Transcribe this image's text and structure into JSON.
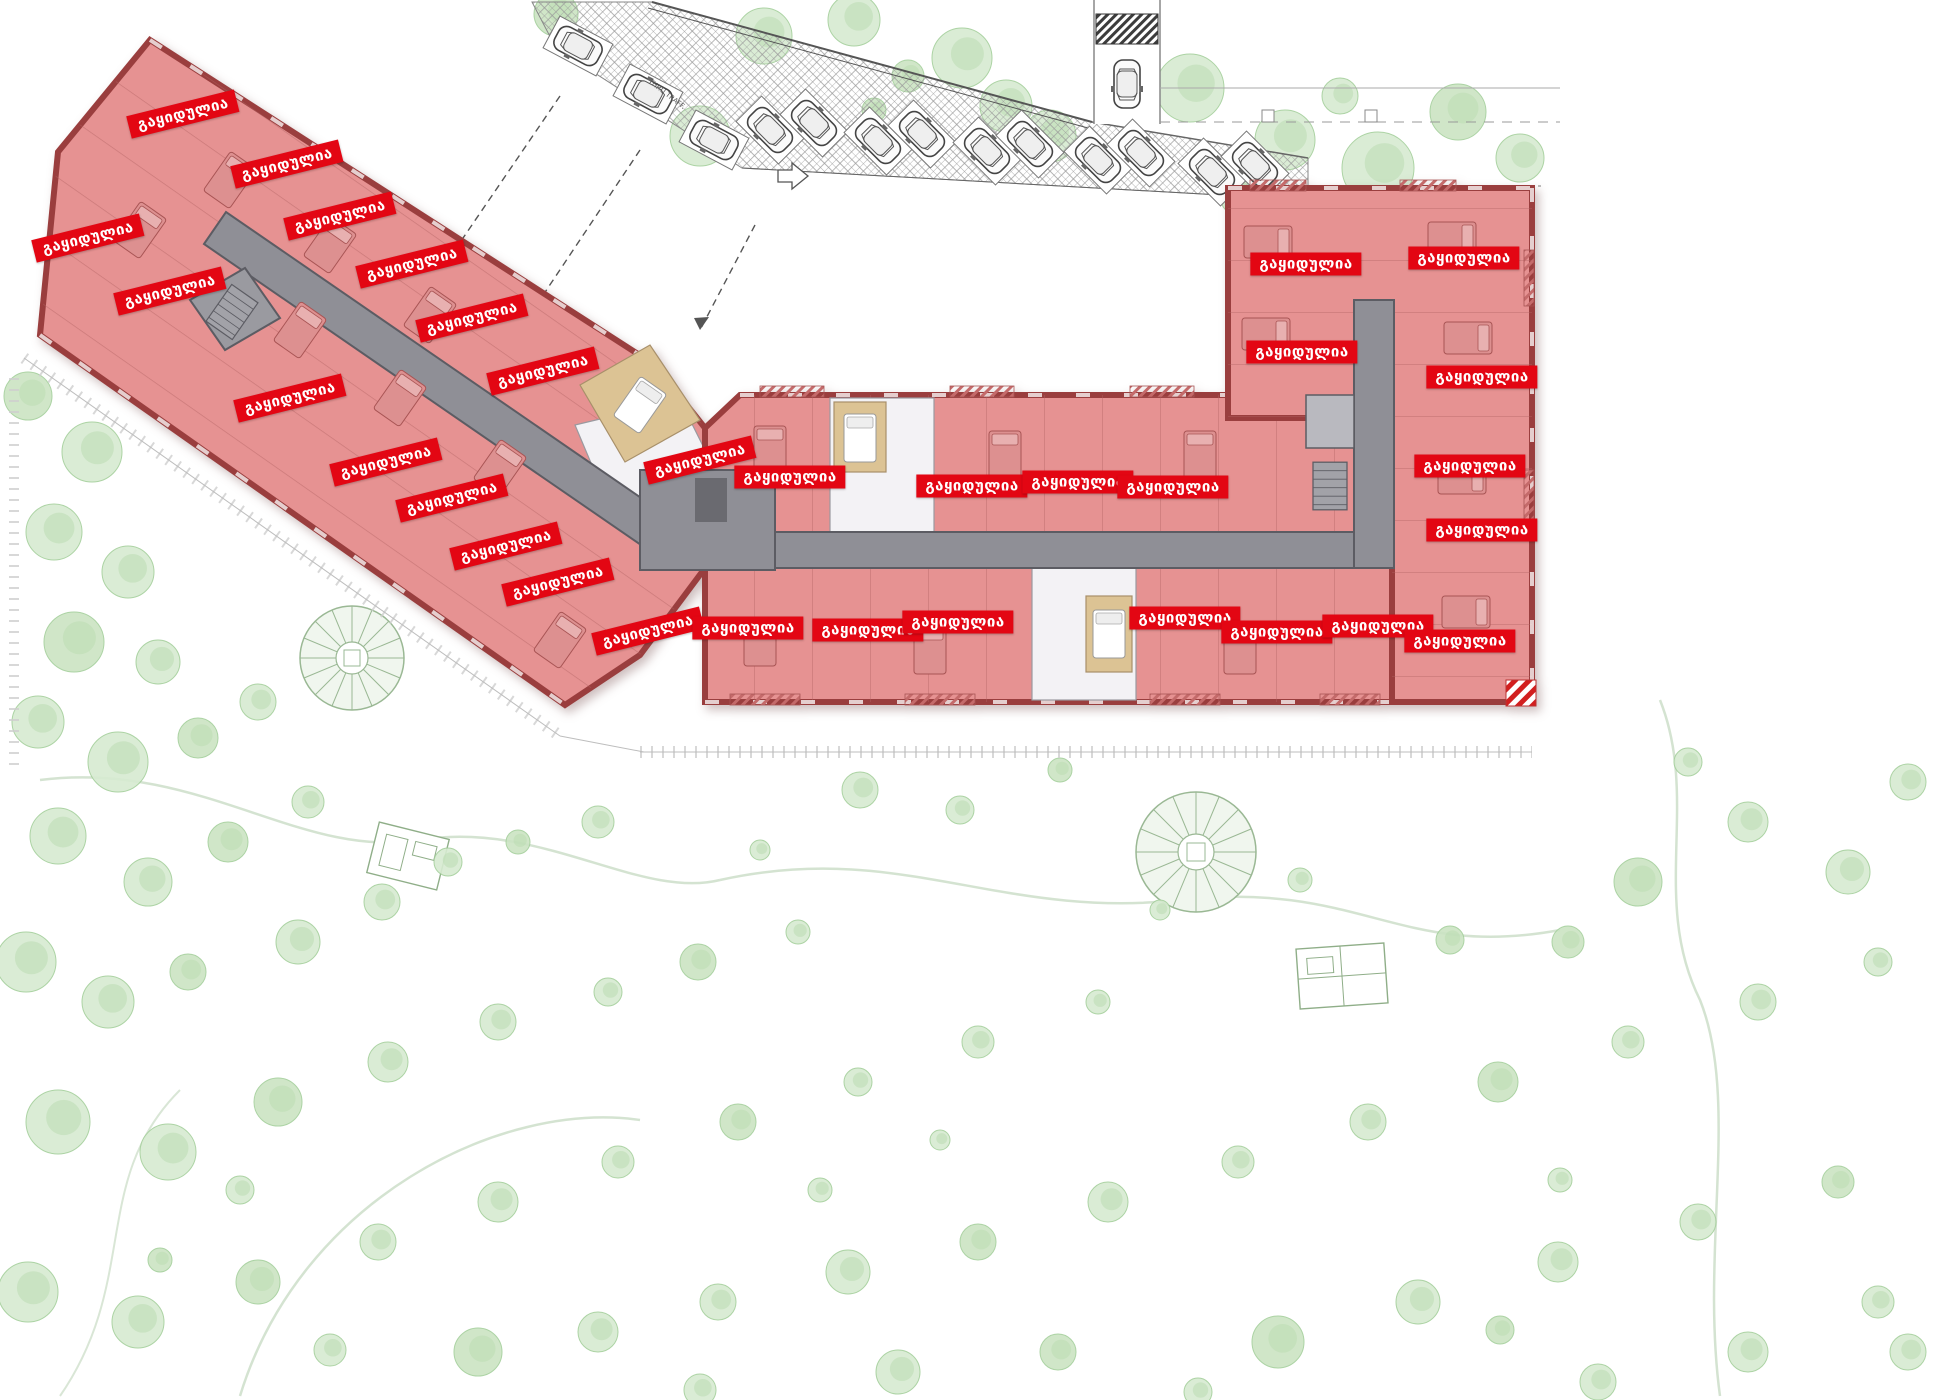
{
  "labels": {
    "sold": "გაყიდულია",
    "stop": "STOP",
    "traffic_note": "THRU TRAFF."
  },
  "colors": {
    "sold_badge_bg": "#e30613",
    "sold_badge_text": "#ffffff",
    "sold_fill": "#e69292",
    "sold_wall": "#9a3e3e",
    "partition": "#b26262",
    "corridor": "#8f8f96",
    "corridor_wall": "#5c5c63",
    "white_floor": "#f3f2f5",
    "wood_floor": "#dcc394",
    "tree_fill": "#d7ebd1",
    "tree_stroke": "#a4cf9b",
    "hatch_line": "#8a8a8a"
  },
  "sold_units": [
    {
      "x": 183,
      "y": 114,
      "rot": -14
    },
    {
      "x": 287,
      "y": 164,
      "rot": -14
    },
    {
      "x": 340,
      "y": 216,
      "rot": -14
    },
    {
      "x": 412,
      "y": 264,
      "rot": -14
    },
    {
      "x": 472,
      "y": 318,
      "rot": -14
    },
    {
      "x": 543,
      "y": 371,
      "rot": -14
    },
    {
      "x": 88,
      "y": 238,
      "rot": -14
    },
    {
      "x": 170,
      "y": 291,
      "rot": -14
    },
    {
      "x": 290,
      "y": 398,
      "rot": -14
    },
    {
      "x": 386,
      "y": 462,
      "rot": -14
    },
    {
      "x": 452,
      "y": 498,
      "rot": -14
    },
    {
      "x": 506,
      "y": 546,
      "rot": -14
    },
    {
      "x": 558,
      "y": 582,
      "rot": -14
    },
    {
      "x": 648,
      "y": 631,
      "rot": -14
    },
    {
      "x": 700,
      "y": 460,
      "rot": -14
    },
    {
      "x": 790,
      "y": 477,
      "rot": 0
    },
    {
      "x": 972,
      "y": 486,
      "rot": 0
    },
    {
      "x": 1078,
      "y": 482,
      "rot": 0
    },
    {
      "x": 1173,
      "y": 487,
      "rot": 0
    },
    {
      "x": 748,
      "y": 628,
      "rot": 0
    },
    {
      "x": 868,
      "y": 630,
      "rot": 0
    },
    {
      "x": 958,
      "y": 622,
      "rot": 0
    },
    {
      "x": 1185,
      "y": 618,
      "rot": 0
    },
    {
      "x": 1277,
      "y": 632,
      "rot": 0
    },
    {
      "x": 1378,
      "y": 626,
      "rot": 0
    },
    {
      "x": 1306,
      "y": 264,
      "rot": 0
    },
    {
      "x": 1464,
      "y": 258,
      "rot": 0
    },
    {
      "x": 1302,
      "y": 352,
      "rot": 0
    },
    {
      "x": 1482,
      "y": 377,
      "rot": 0
    },
    {
      "x": 1470,
      "y": 466,
      "rot": 0
    },
    {
      "x": 1482,
      "y": 530,
      "rot": 0
    },
    {
      "x": 1460,
      "y": 641,
      "rot": 0
    }
  ],
  "parking": {
    "cars": [
      {
        "x": 578,
        "y": 46,
        "rot": -62,
        "bay": true
      },
      {
        "x": 648,
        "y": 94,
        "rot": -62,
        "bay": true
      },
      {
        "x": 714,
        "y": 140,
        "rot": -62,
        "bay": true
      },
      {
        "x": 770,
        "y": 130,
        "rot": -45,
        "bay": true
      },
      {
        "x": 814,
        "y": 123,
        "rot": -45,
        "bay": true
      },
      {
        "x": 878,
        "y": 141,
        "rot": -45,
        "bay": true
      },
      {
        "x": 922,
        "y": 134,
        "rot": -45,
        "bay": true
      },
      {
        "x": 987,
        "y": 151,
        "rot": -45,
        "bay": true
      },
      {
        "x": 1030,
        "y": 144,
        "rot": -45,
        "bay": true
      },
      {
        "x": 1098,
        "y": 160,
        "rot": -45,
        "bay": true
      },
      {
        "x": 1141,
        "y": 153,
        "rot": -45,
        "bay": true
      },
      {
        "x": 1212,
        "y": 172,
        "rot": -45,
        "bay": true
      },
      {
        "x": 1255,
        "y": 165,
        "rot": -45,
        "bay": true
      },
      {
        "x": 1127,
        "y": 84,
        "rot": 180,
        "bay": false
      }
    ],
    "stop": {
      "x": 1313,
      "y": 223
    }
  },
  "landscape": {
    "trees": [
      [
        556,
        14,
        22
      ],
      [
        700,
        136,
        30
      ],
      [
        764,
        36,
        28
      ],
      [
        854,
        20,
        26
      ],
      [
        908,
        76,
        16
      ],
      [
        962,
        58,
        30
      ],
      [
        1006,
        106,
        26
      ],
      [
        1050,
        136,
        26
      ],
      [
        874,
        110,
        12
      ],
      [
        1190,
        88,
        34
      ],
      [
        1285,
        140,
        30
      ],
      [
        1378,
        168,
        36
      ],
      [
        1458,
        112,
        28
      ],
      [
        1520,
        158,
        24
      ],
      [
        1340,
        96,
        18
      ],
      [
        1240,
        196,
        20
      ],
      [
        28,
        396,
        24
      ],
      [
        92,
        452,
        30
      ],
      [
        54,
        532,
        28
      ],
      [
        128,
        572,
        26
      ],
      [
        74,
        642,
        30
      ],
      [
        158,
        662,
        22
      ],
      [
        38,
        722,
        26
      ],
      [
        118,
        762,
        30
      ],
      [
        198,
        738,
        20
      ],
      [
        258,
        702,
        18
      ],
      [
        58,
        836,
        28
      ],
      [
        148,
        882,
        24
      ],
      [
        228,
        842,
        20
      ],
      [
        308,
        802,
        16
      ],
      [
        26,
        962,
        30
      ],
      [
        108,
        1002,
        26
      ],
      [
        188,
        972,
        18
      ],
      [
        298,
        942,
        22
      ],
      [
        382,
        902,
        18
      ],
      [
        448,
        862,
        14
      ],
      [
        518,
        842,
        12
      ],
      [
        598,
        822,
        16
      ],
      [
        58,
        1122,
        32
      ],
      [
        168,
        1152,
        28
      ],
      [
        278,
        1102,
        24
      ],
      [
        388,
        1062,
        20
      ],
      [
        498,
        1022,
        18
      ],
      [
        608,
        992,
        14
      ],
      [
        698,
        962,
        18
      ],
      [
        798,
        932,
        12
      ],
      [
        28,
        1292,
        30
      ],
      [
        138,
        1322,
        26
      ],
      [
        258,
        1282,
        22
      ],
      [
        378,
        1242,
        18
      ],
      [
        498,
        1202,
        20
      ],
      [
        618,
        1162,
        16
      ],
      [
        738,
        1122,
        18
      ],
      [
        858,
        1082,
        14
      ],
      [
        978,
        1042,
        16
      ],
      [
        1098,
        1002,
        12
      ],
      [
        478,
        1352,
        24
      ],
      [
        598,
        1332,
        20
      ],
      [
        718,
        1302,
        18
      ],
      [
        848,
        1272,
        22
      ],
      [
        978,
        1242,
        18
      ],
      [
        1108,
        1202,
        20
      ],
      [
        1238,
        1162,
        16
      ],
      [
        1368,
        1122,
        18
      ],
      [
        1498,
        1082,
        20
      ],
      [
        1628,
        1042,
        16
      ],
      [
        1758,
        1002,
        18
      ],
      [
        1878,
        962,
        14
      ],
      [
        1278,
        1342,
        26
      ],
      [
        1418,
        1302,
        22
      ],
      [
        1558,
        1262,
        20
      ],
      [
        1698,
        1222,
        18
      ],
      [
        1838,
        1182,
        16
      ],
      [
        1908,
        1352,
        18
      ],
      [
        1598,
        1382,
        18
      ],
      [
        898,
        1372,
        22
      ],
      [
        1058,
        1352,
        18
      ],
      [
        1198,
        1392,
        14
      ],
      [
        1748,
        1352,
        20
      ],
      [
        1878,
        1302,
        16
      ],
      [
        1638,
        882,
        24
      ],
      [
        1748,
        822,
        20
      ],
      [
        1848,
        872,
        22
      ],
      [
        1908,
        782,
        18
      ],
      [
        1568,
        942,
        16
      ],
      [
        1688,
        762,
        14
      ],
      [
        860,
        790,
        18
      ],
      [
        960,
        810,
        14
      ],
      [
        1060,
        770,
        12
      ],
      [
        760,
        850,
        10
      ],
      [
        1160,
        910,
        10
      ],
      [
        1300,
        880,
        12
      ],
      [
        1450,
        940,
        14
      ],
      [
        1560,
        1180,
        12
      ],
      [
        240,
        1190,
        14
      ],
      [
        330,
        1350,
        16
      ],
      [
        160,
        1260,
        12
      ],
      [
        700,
        1390,
        16
      ],
      [
        820,
        1190,
        12
      ],
      [
        940,
        1140,
        10
      ],
      [
        1500,
        1330,
        14
      ]
    ]
  }
}
